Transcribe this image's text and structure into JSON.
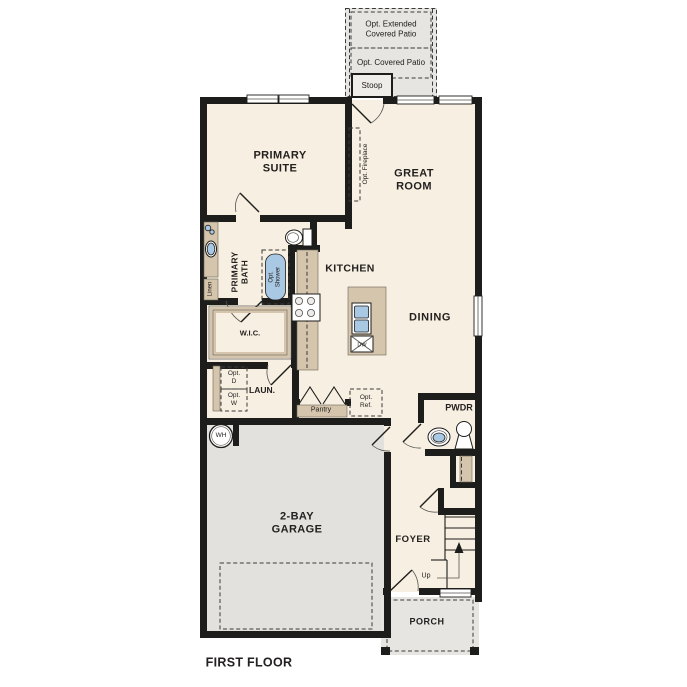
{
  "title": "FIRST FLOOR",
  "colors": {
    "wall": "#1d1d1b",
    "floor": "#f7efe1",
    "garage_floor": "#e2e1dd",
    "patio": "#e7e5e2",
    "cabinet": "#d4c5ac",
    "fixture": "#a9c8e3",
    "text": "#232020"
  },
  "outdoor": {
    "extended_patio": "Opt. Extended\nCovered Patio",
    "covered_patio": "Opt. Covered Patio",
    "stoop": "Stoop",
    "porch": "PORCH"
  },
  "rooms": {
    "primary_suite": "PRIMARY\nSUITE",
    "great_room": "GREAT\nROOM",
    "kitchen": "KITCHEN",
    "dining": "DINING",
    "primary_bath": "PRIMARY\nBATH",
    "wic": "W.I.C.",
    "laundry": "LAUN.",
    "pantry": "Pantry",
    "powder_room": "PWDR",
    "foyer": "FOYER",
    "garage": "2-BAY\nGARAGE"
  },
  "features": {
    "opt_fireplace": "Opt. Fireplace",
    "opt_shower": "Opt.\nShower",
    "opt_dryer": "Opt.\nD",
    "opt_washer": "Opt.\nW",
    "opt_refrigerator": "Opt.\nRef.",
    "linen": "Linen",
    "water_heater": "WH",
    "dishwasher": "DW",
    "stairs_direction": "Up"
  }
}
